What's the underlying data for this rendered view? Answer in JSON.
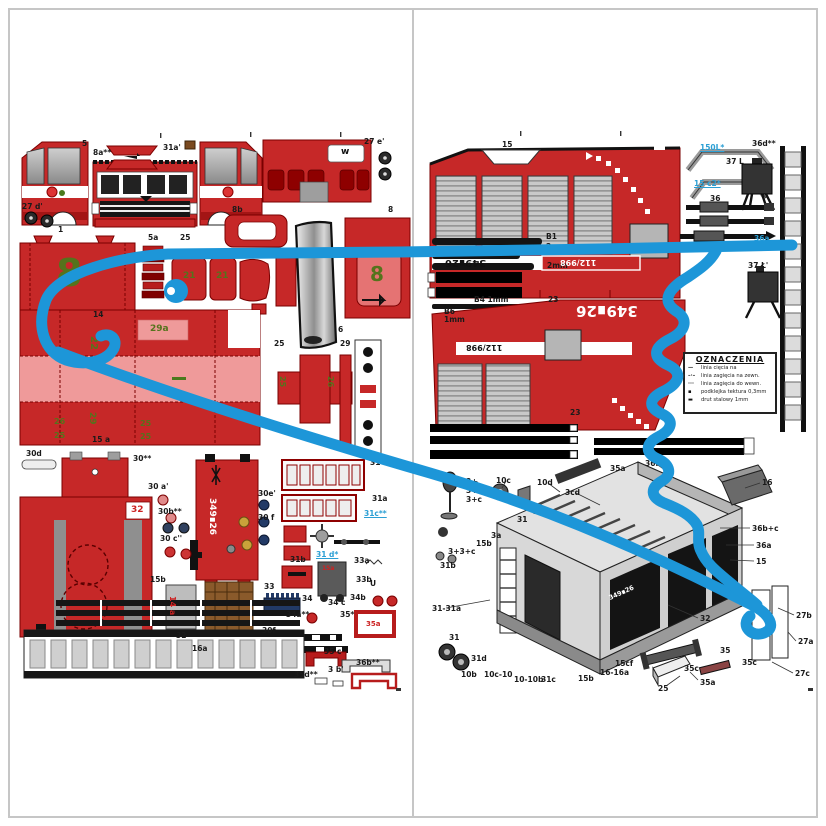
{
  "document": {
    "type": "paper-model cut-out sheet, two-page spread",
    "subject": "fire truck card model parts",
    "truck_code": "349∎26",
    "emergency_number": "112/998"
  },
  "colors": {
    "part_red": "#c62828",
    "part_red_dark": "#8e0000",
    "part_pink": "#ef9a9a",
    "annotation_blue": "#1d96d8",
    "green_number": "#55731c",
    "navy": "#223a66",
    "frame_gray": "#c6c6c6",
    "strip_black": "#141414"
  },
  "legend": {
    "title": "OZNACZENIA",
    "rows": [
      {
        "sym": "—",
        "text": "linia cięcia na"
      },
      {
        "sym": "–·–",
        "text": "linia zagięcia na zewn."
      },
      {
        "sym": "···",
        "text": "linia zagięcia do wewn."
      },
      {
        "sym": "▪",
        "text": "podklejka tektura 0,3mm"
      },
      {
        "sym": "▬",
        "text": "drut stalowy 1mm"
      }
    ]
  },
  "labels": [
    {
      "t": "5",
      "x": 82,
      "y": 140
    },
    {
      "t": "8a**",
      "x": 93,
      "y": 149
    },
    {
      "t": "31a'",
      "x": 163,
      "y": 144
    },
    {
      "t": "27 e'",
      "x": 364,
      "y": 138
    },
    {
      "t": "w",
      "x": 341,
      "y": 148,
      "c": "dk",
      "f": 9
    },
    {
      "t": "8",
      "x": 388,
      "y": 206
    },
    {
      "t": "27 d'",
      "x": 22,
      "y": 203
    },
    {
      "t": "1",
      "x": 58,
      "y": 226
    },
    {
      "t": "5a",
      "x": 148,
      "y": 234
    },
    {
      "t": "25",
      "x": 180,
      "y": 234
    },
    {
      "t": "8b",
      "x": 232,
      "y": 206
    },
    {
      "t": "6",
      "x": 338,
      "y": 326
    },
    {
      "t": "25",
      "x": 274,
      "y": 340
    },
    {
      "t": "29",
      "x": 340,
      "y": 340
    },
    {
      "t": "8",
      "x": 56,
      "y": 254,
      "c": "gr",
      "f": 38
    },
    {
      "t": "8",
      "x": 370,
      "y": 264,
      "c": "gr",
      "f": 20
    },
    {
      "t": "21",
      "x": 183,
      "y": 272,
      "c": "gr",
      "f": 9
    },
    {
      "t": "21",
      "x": 216,
      "y": 272,
      "c": "gr",
      "f": 9
    },
    {
      "t": "14",
      "x": 93,
      "y": 311
    },
    {
      "t": "29a",
      "x": 150,
      "y": 325,
      "c": "gr",
      "f": 9
    },
    {
      "t": "22",
      "x": 98,
      "y": 336,
      "c": "gr r90",
      "f": 10
    },
    {
      "t": "29",
      "x": 96,
      "y": 412,
      "c": "gr r90",
      "f": 9
    },
    {
      "t": "26",
      "x": 54,
      "y": 418,
      "c": "gr",
      "f": 8
    },
    {
      "t": "25",
      "x": 54,
      "y": 432,
      "c": "gr",
      "f": 8
    },
    {
      "t": "25",
      "x": 140,
      "y": 420,
      "c": "gr",
      "f": 8
    },
    {
      "t": "25",
      "x": 140,
      "y": 433,
      "c": "gr",
      "f": 8
    },
    {
      "t": "25",
      "x": 286,
      "y": 376,
      "c": "gr r90",
      "f": 8
    },
    {
      "t": "26",
      "x": 334,
      "y": 376,
      "c": "gr r90",
      "f": 8
    },
    {
      "t": "15 a",
      "x": 92,
      "y": 436
    },
    {
      "t": "30d",
      "x": 26,
      "y": 450
    },
    {
      "t": "30**",
      "x": 133,
      "y": 455
    },
    {
      "t": "30 a'",
      "x": 148,
      "y": 483
    },
    {
      "t": "30b**",
      "x": 158,
      "y": 508
    },
    {
      "t": "30 c''",
      "x": 160,
      "y": 535
    },
    {
      "t": "15b",
      "x": 150,
      "y": 576
    },
    {
      "t": "32",
      "x": 131,
      "y": 506,
      "c": "rd",
      "f": 9
    },
    {
      "t": "349∎26",
      "x": 216,
      "y": 498,
      "c": "wh r90",
      "f": 9
    },
    {
      "t": "14 a",
      "x": 176,
      "y": 596,
      "c": "rd r90",
      "f": 8
    },
    {
      "t": "32",
      "x": 176,
      "y": 632
    },
    {
      "t": "16a",
      "x": 192,
      "y": 645
    },
    {
      "t": "30e'",
      "x": 258,
      "y": 490
    },
    {
      "t": "30 f",
      "x": 258,
      "y": 514
    },
    {
      "t": "31",
      "x": 370,
      "y": 459
    },
    {
      "t": "31a",
      "x": 372,
      "y": 495
    },
    {
      "t": "31c**",
      "x": 364,
      "y": 510,
      "c": "bl"
    },
    {
      "t": "31 d*",
      "x": 316,
      "y": 551,
      "c": "bl"
    },
    {
      "t": "31b",
      "x": 290,
      "y": 556
    },
    {
      "t": "33a",
      "x": 354,
      "y": 557
    },
    {
      "t": "33",
      "x": 264,
      "y": 583
    },
    {
      "t": "15a",
      "x": 322,
      "y": 566,
      "c": "rd",
      "f": 6
    },
    {
      "t": "33b",
      "x": 356,
      "y": 576
    },
    {
      "t": "U",
      "x": 370,
      "y": 580
    },
    {
      "t": "34",
      "x": 302,
      "y": 595
    },
    {
      "t": "34 c",
      "x": 328,
      "y": 599
    },
    {
      "t": "34b",
      "x": 350,
      "y": 594
    },
    {
      "t": "34a**",
      "x": 286,
      "y": 611
    },
    {
      "t": "35*",
      "x": 340,
      "y": 611
    },
    {
      "t": "35a",
      "x": 366,
      "y": 621,
      "c": "rd",
      "f": 7
    },
    {
      "t": "30f",
      "x": 262,
      "y": 627
    },
    {
      "t": "35 c",
      "x": 324,
      "y": 648
    },
    {
      "t": "36b**",
      "x": 356,
      "y": 659
    },
    {
      "t": "35d**",
      "x": 294,
      "y": 671
    },
    {
      "t": "3 b'",
      "x": 328,
      "y": 666
    },
    {
      "t": "15",
      "x": 502,
      "y": 141
    },
    {
      "t": "150L*",
      "x": 700,
      "y": 144,
      "c": "bl"
    },
    {
      "t": "15 c2*",
      "x": 694,
      "y": 180,
      "c": "bl"
    },
    {
      "t": "36",
      "x": 710,
      "y": 195
    },
    {
      "t": "36a",
      "x": 754,
      "y": 235,
      "c": "bl"
    },
    {
      "t": "37 L",
      "x": 726,
      "y": 158
    },
    {
      "t": "36d**",
      "x": 752,
      "y": 140
    },
    {
      "t": "37 Ł'",
      "x": 748,
      "y": 262
    },
    {
      "t": "B1",
      "x": 546,
      "y": 233
    },
    {
      "t": "2mm",
      "x": 546,
      "y": 243
    },
    {
      "t": "2mm",
      "x": 547,
      "y": 262
    },
    {
      "t": "B4 1mm",
      "x": 474,
      "y": 296
    },
    {
      "t": "23",
      "x": 548,
      "y": 296
    },
    {
      "t": "B6",
      "x": 444,
      "y": 308
    },
    {
      "t": "1mm",
      "x": 444,
      "y": 316
    },
    {
      "t": "349∎26",
      "x": 445,
      "y": 257,
      "c": "dk r180",
      "f": 10
    },
    {
      "t": "112/998",
      "x": 560,
      "y": 258,
      "c": "wh r180",
      "f": 8
    },
    {
      "t": "349∎26",
      "x": 576,
      "y": 303,
      "c": "wh r180",
      "f": 15
    },
    {
      "t": "112/998",
      "x": 466,
      "y": 343,
      "c": "dk r180",
      "f": 8
    },
    {
      "t": "23",
      "x": 570,
      "y": 409
    },
    {
      "t": "3+",
      "x": 466,
      "y": 478
    },
    {
      "t": "3+b",
      "x": 466,
      "y": 487
    },
    {
      "t": "3+c",
      "x": 466,
      "y": 496
    },
    {
      "t": "10c",
      "x": 496,
      "y": 477
    },
    {
      "t": "10d",
      "x": 537,
      "y": 479
    },
    {
      "t": "3cd",
      "x": 565,
      "y": 489
    },
    {
      "t": "36f",
      "x": 645,
      "y": 460
    },
    {
      "t": "35a",
      "x": 610,
      "y": 465
    },
    {
      "t": "3b",
      "x": 533,
      "y": 508
    },
    {
      "t": "31",
      "x": 517,
      "y": 516
    },
    {
      "t": "3a",
      "x": 491,
      "y": 532
    },
    {
      "t": "15b",
      "x": 476,
      "y": 540
    },
    {
      "t": "3+3+c",
      "x": 448,
      "y": 548
    },
    {
      "t": "31b",
      "x": 440,
      "y": 562
    },
    {
      "t": "31-31a",
      "x": 432,
      "y": 605
    },
    {
      "t": "31",
      "x": 449,
      "y": 634
    },
    {
      "t": "31d",
      "x": 471,
      "y": 655
    },
    {
      "t": "10b",
      "x": 461,
      "y": 671
    },
    {
      "t": "10c-10",
      "x": 484,
      "y": 671
    },
    {
      "t": "10-10b",
      "x": 514,
      "y": 676
    },
    {
      "t": "31c",
      "x": 541,
      "y": 676
    },
    {
      "t": "15b",
      "x": 578,
      "y": 675
    },
    {
      "t": "16-16a",
      "x": 600,
      "y": 669
    },
    {
      "t": "15cf",
      "x": 615,
      "y": 660
    },
    {
      "t": "25",
      "x": 658,
      "y": 685
    },
    {
      "t": "35a",
      "x": 700,
      "y": 679
    },
    {
      "t": "35c",
      "x": 684,
      "y": 665
    },
    {
      "t": "35",
      "x": 720,
      "y": 647
    },
    {
      "t": "35c",
      "x": 742,
      "y": 659
    },
    {
      "t": "32",
      "x": 700,
      "y": 615
    },
    {
      "t": "16",
      "x": 762,
      "y": 479
    },
    {
      "t": "36b+c",
      "x": 752,
      "y": 525
    },
    {
      "t": "36a",
      "x": 756,
      "y": 542
    },
    {
      "t": "15",
      "x": 756,
      "y": 558
    },
    {
      "t": "27b",
      "x": 796,
      "y": 612
    },
    {
      "t": "27a",
      "x": 798,
      "y": 638
    },
    {
      "t": "27c",
      "x": 795,
      "y": 670
    }
  ]
}
